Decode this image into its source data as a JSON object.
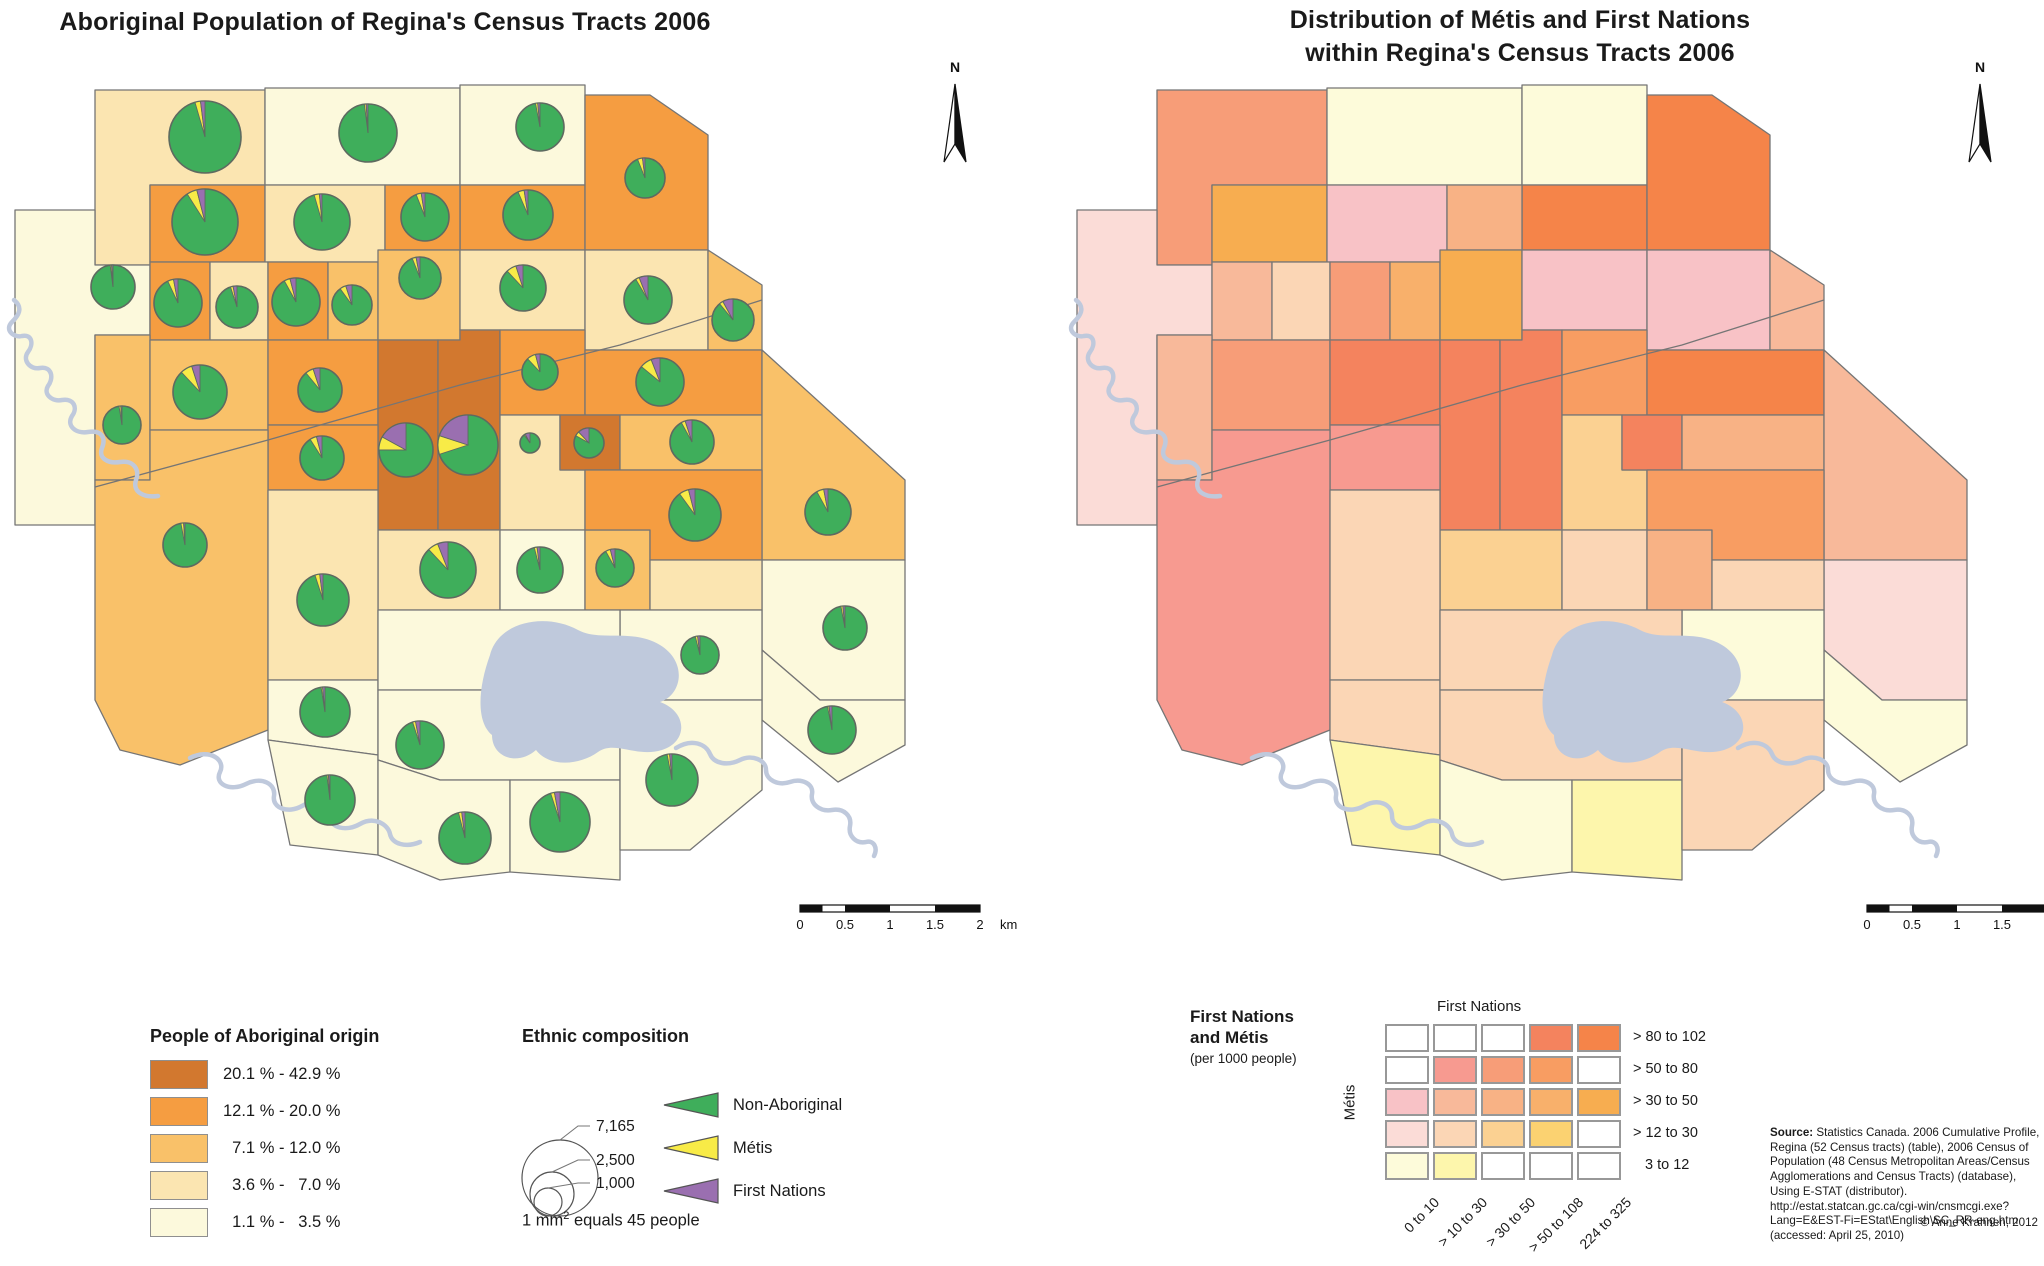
{
  "left_panel": {
    "title": "Aboriginal Population of Regina's Census Tracts 2006",
    "legend_classes": {
      "title": "People of Aboriginal origin",
      "items": [
        {
          "color": "#D2782F",
          "label": "20.1 % - 42.9 %"
        },
        {
          "color": "#F59D41",
          "label": "12.1 % - 20.0 %"
        },
        {
          "color": "#F9C169",
          "label": "  7.1 % - 12.0 %"
        },
        {
          "color": "#FBE5B1",
          "label": "  3.6 % -   7.0 %"
        },
        {
          "color": "#FCF9DC",
          "label": "  1.1 % -   3.5 %"
        }
      ]
    },
    "legend_composition": {
      "title": "Ethnic composition",
      "circles": [
        {
          "value": "7,165",
          "r": 38
        },
        {
          "value": "2,500",
          "r": 22
        },
        {
          "value": "1,000",
          "r": 14
        }
      ],
      "wedges": [
        {
          "color": "#3FAE5B",
          "label": "Non-Aboriginal"
        },
        {
          "color": "#F8EB47",
          "label": "Métis"
        },
        {
          "color": "#9A6FB0",
          "label": "First Nations"
        }
      ],
      "caption_prefix": "1 mm",
      "caption_sup": "2",
      "caption_suffix": " equals 45 people"
    }
  },
  "right_panel": {
    "title_line1": "Distribution of Métis and First Nations",
    "title_line2": "within Regina's Census Tracts 2006",
    "bivariate": {
      "title_line1": "First Nations",
      "title_line2": "and Métis",
      "subtitle": "(per 1000 people)",
      "x_title": "First Nations",
      "y_title": "Métis",
      "row_labels": [
        "> 80 to 102",
        "> 50 to  80",
        "> 30 to  50",
        "> 12 to  30",
        "3 to  12"
      ],
      "col_labels": [
        "0 to 10",
        "> 10 to 30",
        "> 30 to 50",
        "> 50 to 108",
        "224 to 325"
      ],
      "cells": [
        [
          "#FFFFFF",
          "#FFFFFF",
          "#FFFFFF",
          "#F4835E",
          "#F58449"
        ],
        [
          "#FFFFFF",
          "#F79A90",
          "#F79D78",
          "#F89D62",
          "#FFFFFF"
        ],
        [
          "#F8C2C6",
          "#F8B99A",
          "#F8B285",
          "#F8B06B",
          "#F7AD50"
        ],
        [
          "#FBDCD7",
          "#FBD6B5",
          "#FBD192",
          "#FBD271",
          "#FFFFFF"
        ],
        [
          "#FDFBDA",
          "#FDF6AC",
          "#FFFFFF",
          "#FFFFFF",
          "#FFFFFF"
        ]
      ]
    },
    "source_label": "Source:",
    "source_text": " Statistics Canada. 2006 Cumulative Profile, Regina (52 Census tracts) (table), 2006 Census of Population (48 Census Metropolitan Areas/Census Agglomerations and Census Tracts) (database), Using E-STAT (distributor). http://estat.statcan.gc.ca/cgi-win/cnsmcgi.exe?Lang=E&EST-Fi=EStat\\English\\SC_RR-eng.htm (accessed: April 25, 2010)",
    "copyright": "© Anne Krahnen, 2012"
  },
  "north_label": "N",
  "scalebar": {
    "labels": [
      "0",
      "0.5",
      "1",
      "1.5",
      "2"
    ],
    "unit": "km"
  },
  "map": {
    "choropleth_colors": {
      "c1": "#D2782F",
      "c2": "#F59D41",
      "c3": "#F9C169",
      "c4": "#FBE5B1",
      "c5": "#FCF9DC"
    },
    "pie_colors": {
      "non_aboriginal": "#3FAE5B",
      "metis": "#F8EB47",
      "first_nations": "#9A6FB0"
    },
    "pie_border": "#5E6A60",
    "water_color": "#BFC9DC",
    "border_color": "#757575",
    "diagonal_boundary": "M95,487 L268,440 L460,385 L620,345 L762,300",
    "lake": "M490,655 C498,622 545,612 578,630 C600,642 632,628 660,645 C688,662 682,695 660,702 C688,712 688,742 662,750 C636,758 615,740 598,752 C580,765 550,768 536,750 C518,766 492,758 492,735 C476,722 478,688 490,655 Z",
    "rivers": [
      "M14,300 c10,8 4,16 -2,22 c-8,8 2,16 10,14 c10,-2 12,8 6,16 c-6,8 2,18 12,16 c12,-2 14,10 8,18 c-5,8 4,16 14,14 c12,-2 16,8 10,16 c-6,10 4,18 16,16 c14,-2 18,6 14,16 c-4,10 6,16 18,14 c14,-2 20,8 16,18 c-4,12 8,18 22,16",
      "M190,758 c20,-10 36,2 30,14 c-6,12 10,20 26,12 c16,-8 30,0 28,12 c-2,12 14,18 28,10 c14,-8 28,-2 28,10 c0,12 16,16 30,8 c14,-8 28,0 30,10 c2,10 16,14 30,8",
      "M676,748 c16,-10 30,-4 34,6 c4,10 18,12 30,6 c12,-6 26,0 26,10 c0,10 12,16 24,12 c12,-4 24,2 22,12 c-2,10 8,18 20,16 c12,-2 20,6 18,16 c-2,10 6,18 16,16 c8,-2 12,6 8,14"
    ],
    "tracts": [
      {
        "pts": "95,90 265,90 265,185 150,185 150,265 95,265",
        "cls": "c4",
        "biv": "#F79D78",
        "pie": [
          205,
          137,
          36,
          2.5,
          2
        ]
      },
      {
        "pts": "265,88 460,88 460,185 265,185",
        "cls": "c5",
        "biv": "#FDFBDA",
        "pie": [
          368,
          133,
          29,
          1,
          1
        ]
      },
      {
        "pts": "460,85 585,85 585,185 460,185",
        "cls": "c5",
        "biv": "#FDFBDA",
        "pie": [
          540,
          127,
          24,
          1.5,
          1.5
        ]
      },
      {
        "pts": "460,185 585,185 585,250 460,250",
        "cls": "c2",
        "biv": "#F58449",
        "pie": [
          528,
          215,
          25,
          4,
          2.5
        ]
      },
      {
        "pts": "585,95 650,95 708,135 708,250 585,250",
        "cls": "c2",
        "biv": "#F58449",
        "pie": [
          645,
          178,
          20,
          4,
          2
        ]
      },
      {
        "pts": "150,185 265,185 265,262 150,262",
        "cls": "c2",
        "biv": "#F7AD50",
        "pie": [
          205,
          222,
          33,
          5,
          4
        ]
      },
      {
        "pts": "265,185 385,185 385,262 265,262",
        "cls": "c4",
        "biv": "#F8C2C6",
        "pie": [
          322,
          222,
          28,
          3,
          1.5
        ]
      },
      {
        "pts": "385,185 460,185 460,250 385,250",
        "cls": "c2",
        "biv": "#F8B285",
        "pie": [
          425,
          217,
          24,
          3.5,
          2.5
        ]
      },
      {
        "pts": "15,210 95,210 95,265 150,265 150,335 95,335 95,525 15,525",
        "cls": "c5",
        "biv": "#FBDCD7",
        "pie": [
          113,
          287,
          22,
          1,
          1
        ]
      },
      {
        "pts": "150,262 210,262 210,340 150,340",
        "cls": "c2",
        "biv": "#F8B99A",
        "pie": [
          178,
          303,
          24,
          4,
          3
        ]
      },
      {
        "pts": "210,262 268,262 268,340 210,340",
        "cls": "c4",
        "biv": "#FBD6B5",
        "pie": [
          237,
          307,
          21,
          2,
          3
        ]
      },
      {
        "pts": "268,262 328,262 328,340 268,340",
        "cls": "c2",
        "biv": "#F79D78",
        "pie": [
          296,
          302,
          24,
          4,
          4
        ]
      },
      {
        "pts": "328,262 378,262 378,340 328,340",
        "cls": "c3",
        "biv": "#F8B06B",
        "pie": [
          352,
          305,
          20,
          5,
          5
        ]
      },
      {
        "pts": "378,250 460,250 460,340 378,340",
        "cls": "c3",
        "biv": "#F7AD50",
        "pie": [
          420,
          278,
          21,
          3,
          3
        ]
      },
      {
        "pts": "460,250 585,250 585,330 460,330",
        "cls": "c4",
        "biv": "#F8C2C6",
        "pie": [
          523,
          288,
          23,
          7,
          5
        ]
      },
      {
        "pts": "585,250 708,250 708,350 585,350",
        "cls": "c4",
        "biv": "#F8C2C6",
        "pie": [
          648,
          300,
          24,
          2.5,
          6
        ]
      },
      {
        "pts": "708,250 762,285 762,350 708,350",
        "cls": "c3",
        "biv": "#F8B99A",
        "pie": [
          733,
          320,
          21,
          3,
          8
        ]
      },
      {
        "pts": "95,335 150,335 150,480 95,480",
        "cls": "c3",
        "biv": "#F8B99A",
        "pie": [
          122,
          425,
          19,
          1.5,
          1
        ]
      },
      {
        "pts": "150,340 268,340 268,430 150,430",
        "cls": "c3",
        "biv": "#F79D78",
        "pie": [
          200,
          392,
          27,
          7,
          5
        ]
      },
      {
        "pts": "268,340 378,340 378,425 268,425",
        "cls": "c2",
        "biv": "#F4835E",
        "pie": [
          320,
          390,
          22,
          6,
          5
        ]
      },
      {
        "pts": "378,340 438,340 438,530 378,530",
        "cls": "c1",
        "biv": "#F4835E",
        "pie": [
          406,
          450,
          27,
          8,
          17
        ]
      },
      {
        "pts": "438,340 460,340 460,330 500,330 500,530 438,530",
        "cls": "c1",
        "biv": "#F4835E",
        "pie": [
          468,
          445,
          30,
          10,
          20
        ]
      },
      {
        "pts": "500,330 585,330 585,415 500,415",
        "cls": "c2",
        "biv": "#F89D62",
        "pie": [
          540,
          372,
          18,
          8,
          4
        ]
      },
      {
        "pts": "585,350 762,350 762,415 585,415",
        "cls": "c2",
        "biv": "#F58449",
        "pie": [
          660,
          382,
          24,
          8,
          6
        ]
      },
      {
        "pts": "268,425 378,425 378,490 268,490",
        "cls": "c2",
        "biv": "#F79A90",
        "pie": [
          322,
          458,
          22,
          5,
          4
        ]
      },
      {
        "pts": "500,415 560,415 560,470 585,470 585,530 500,530",
        "cls": "c4",
        "biv": "#FBD192",
        "pie": [
          530,
          443,
          10,
          2,
          8
        ]
      },
      {
        "pts": "560,415 620,415 620,470 560,470",
        "cls": "c1",
        "biv": "#F4835E",
        "pie": [
          589,
          443,
          15,
          5,
          12
        ]
      },
      {
        "pts": "620,415 762,415 762,470 620,470",
        "cls": "c3",
        "biv": "#F8B285",
        "pie": [
          692,
          442,
          22,
          3,
          5
        ]
      },
      {
        "pts": "762,350 905,480 905,560 762,560",
        "cls": "c3",
        "biv": "#F8B99A",
        "pie": [
          828,
          512,
          23,
          5,
          3
        ]
      },
      {
        "pts": "762,560 905,560 905,700 820,700 762,650",
        "cls": "c5",
        "biv": "#FBDCD7",
        "pie": [
          845,
          628,
          22,
          1.5,
          1.5
        ]
      },
      {
        "pts": "762,650 820,700 905,700 905,745 838,782 762,720",
        "cls": "c5",
        "biv": "#FDFBDA",
        "pie": [
          832,
          730,
          24,
          1,
          2
        ]
      },
      {
        "pts": "95,480 150,480 150,430 268,430 268,730 180,765 120,750 95,700",
        "cls": "c3",
        "biv": "#F79A90",
        "pie": [
          185,
          545,
          22,
          2,
          1
        ]
      },
      {
        "pts": "378,530 500,530 500,610 378,610",
        "cls": "c4",
        "biv": "#FBD192",
        "pie": [
          448,
          570,
          28,
          6,
          6
        ]
      },
      {
        "pts": "500,530 585,530 585,610 500,610",
        "cls": "c5",
        "biv": "#FBD6B5",
        "pie": [
          540,
          570,
          23,
          2,
          2
        ]
      },
      {
        "pts": "585,530 650,530 650,610 585,610",
        "cls": "c3",
        "biv": "#F8B285",
        "pie": [
          615,
          568,
          19,
          4,
          4
        ]
      },
      {
        "pts": "585,470 762,470 762,560 650,560 650,530 585,530",
        "cls": "c2",
        "biv": "#F89D62",
        "pie": [
          695,
          515,
          26,
          6,
          4
        ]
      },
      {
        "pts": "650,560 762,560 762,610 650,610",
        "cls": "c4",
        "biv": "#FBD6B5",
        "pie": null
      },
      {
        "pts": "268,490 378,490 378,680 268,680",
        "cls": "c4",
        "biv": "#FBD6B5",
        "pie": [
          323,
          600,
          26,
          3,
          2
        ]
      },
      {
        "pts": "268,680 378,680 378,755 268,740",
        "cls": "c5",
        "biv": "#FBD6B5",
        "pie": [
          325,
          712,
          25,
          1,
          1.5
        ]
      },
      {
        "pts": "268,740 378,755 378,855 290,845",
        "cls": "c5",
        "biv": "#FDF6AC",
        "pie": [
          330,
          800,
          25,
          1,
          1
        ]
      },
      {
        "pts": "620,610 762,610 762,700 620,700",
        "cls": "c5",
        "biv": "#FDFBDA",
        "pie": [
          700,
          655,
          19,
          2,
          2
        ]
      },
      {
        "pts": "378,610 620,610 620,690 378,690",
        "cls": "c5",
        "biv": "#FBD6B5",
        "pie": null
      },
      {
        "pts": "378,690 620,690 620,780 440,780 378,760",
        "cls": "c5",
        "biv": "#FBD6B5",
        "pie": [
          420,
          745,
          24,
          2,
          3
        ]
      },
      {
        "pts": "378,760 440,780 510,780 510,872 440,880 378,855",
        "cls": "c5",
        "biv": "#FDFBDA",
        "pie": [
          465,
          838,
          26,
          2,
          2
        ]
      },
      {
        "pts": "510,780 620,780 620,880 510,872",
        "cls": "c5",
        "biv": "#FDF6AC",
        "pie": [
          560,
          822,
          30,
          2,
          3
        ]
      },
      {
        "pts": "620,700 762,700 762,790 690,850 620,850",
        "cls": "c5",
        "biv": "#FBD6B5",
        "pie": [
          672,
          780,
          26,
          1.5,
          1.5
        ]
      }
    ]
  }
}
